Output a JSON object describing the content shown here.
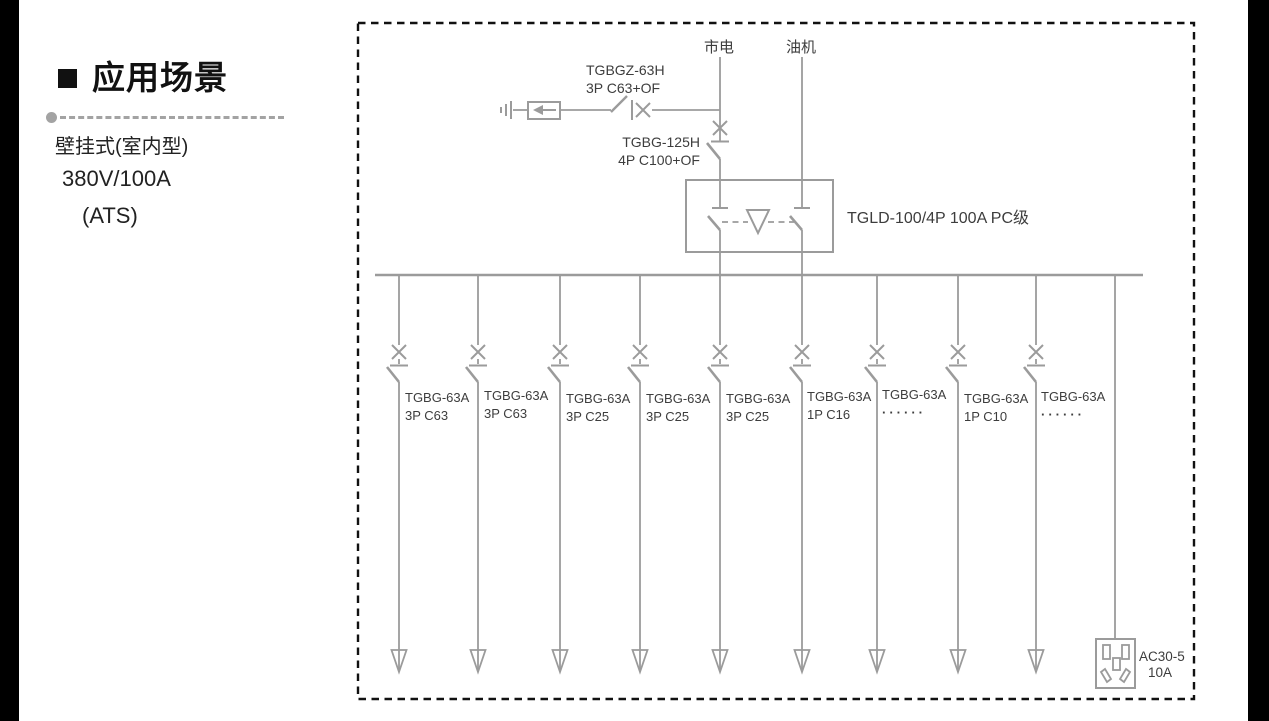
{
  "left_panel": {
    "title": "应用场景",
    "lines": [
      "壁挂式(室内型)",
      "380V/100A",
      "(ATS)"
    ]
  },
  "diagram": {
    "sources": {
      "mains": "市电",
      "generator": "油机"
    },
    "spd_branch": {
      "model": "TGBGZ-63H",
      "spec": "3P C63+OF"
    },
    "main_breaker": {
      "model": "TGBG-125H",
      "spec": "4P C100+OF"
    },
    "ats": {
      "label": "TGLD-100/4P 100A PC级"
    },
    "feeders": [
      {
        "model": "TGBG-63A",
        "spec": "3P C63"
      },
      {
        "model": "TGBG-63A",
        "spec": "3P C63"
      },
      {
        "model": "TGBG-63A",
        "spec": "3P C25"
      },
      {
        "model": "TGBG-63A",
        "spec": "3P C25"
      },
      {
        "model": "TGBG-63A",
        "spec": "3P C25"
      },
      {
        "model": "TGBG-63A",
        "spec": "1P C16"
      },
      {
        "model": "TGBG-63A",
        "spec": "······"
      },
      {
        "model": "TGBG-63A",
        "spec": "1P C10"
      },
      {
        "model": "TGBG-63A",
        "spec": "······"
      }
    ],
    "socket": {
      "model": "AC30-5",
      "rating": "10A"
    },
    "colors": {
      "line": "#9b9b9b",
      "label": "#3d3d3d",
      "frame_dash": "#111111"
    }
  }
}
